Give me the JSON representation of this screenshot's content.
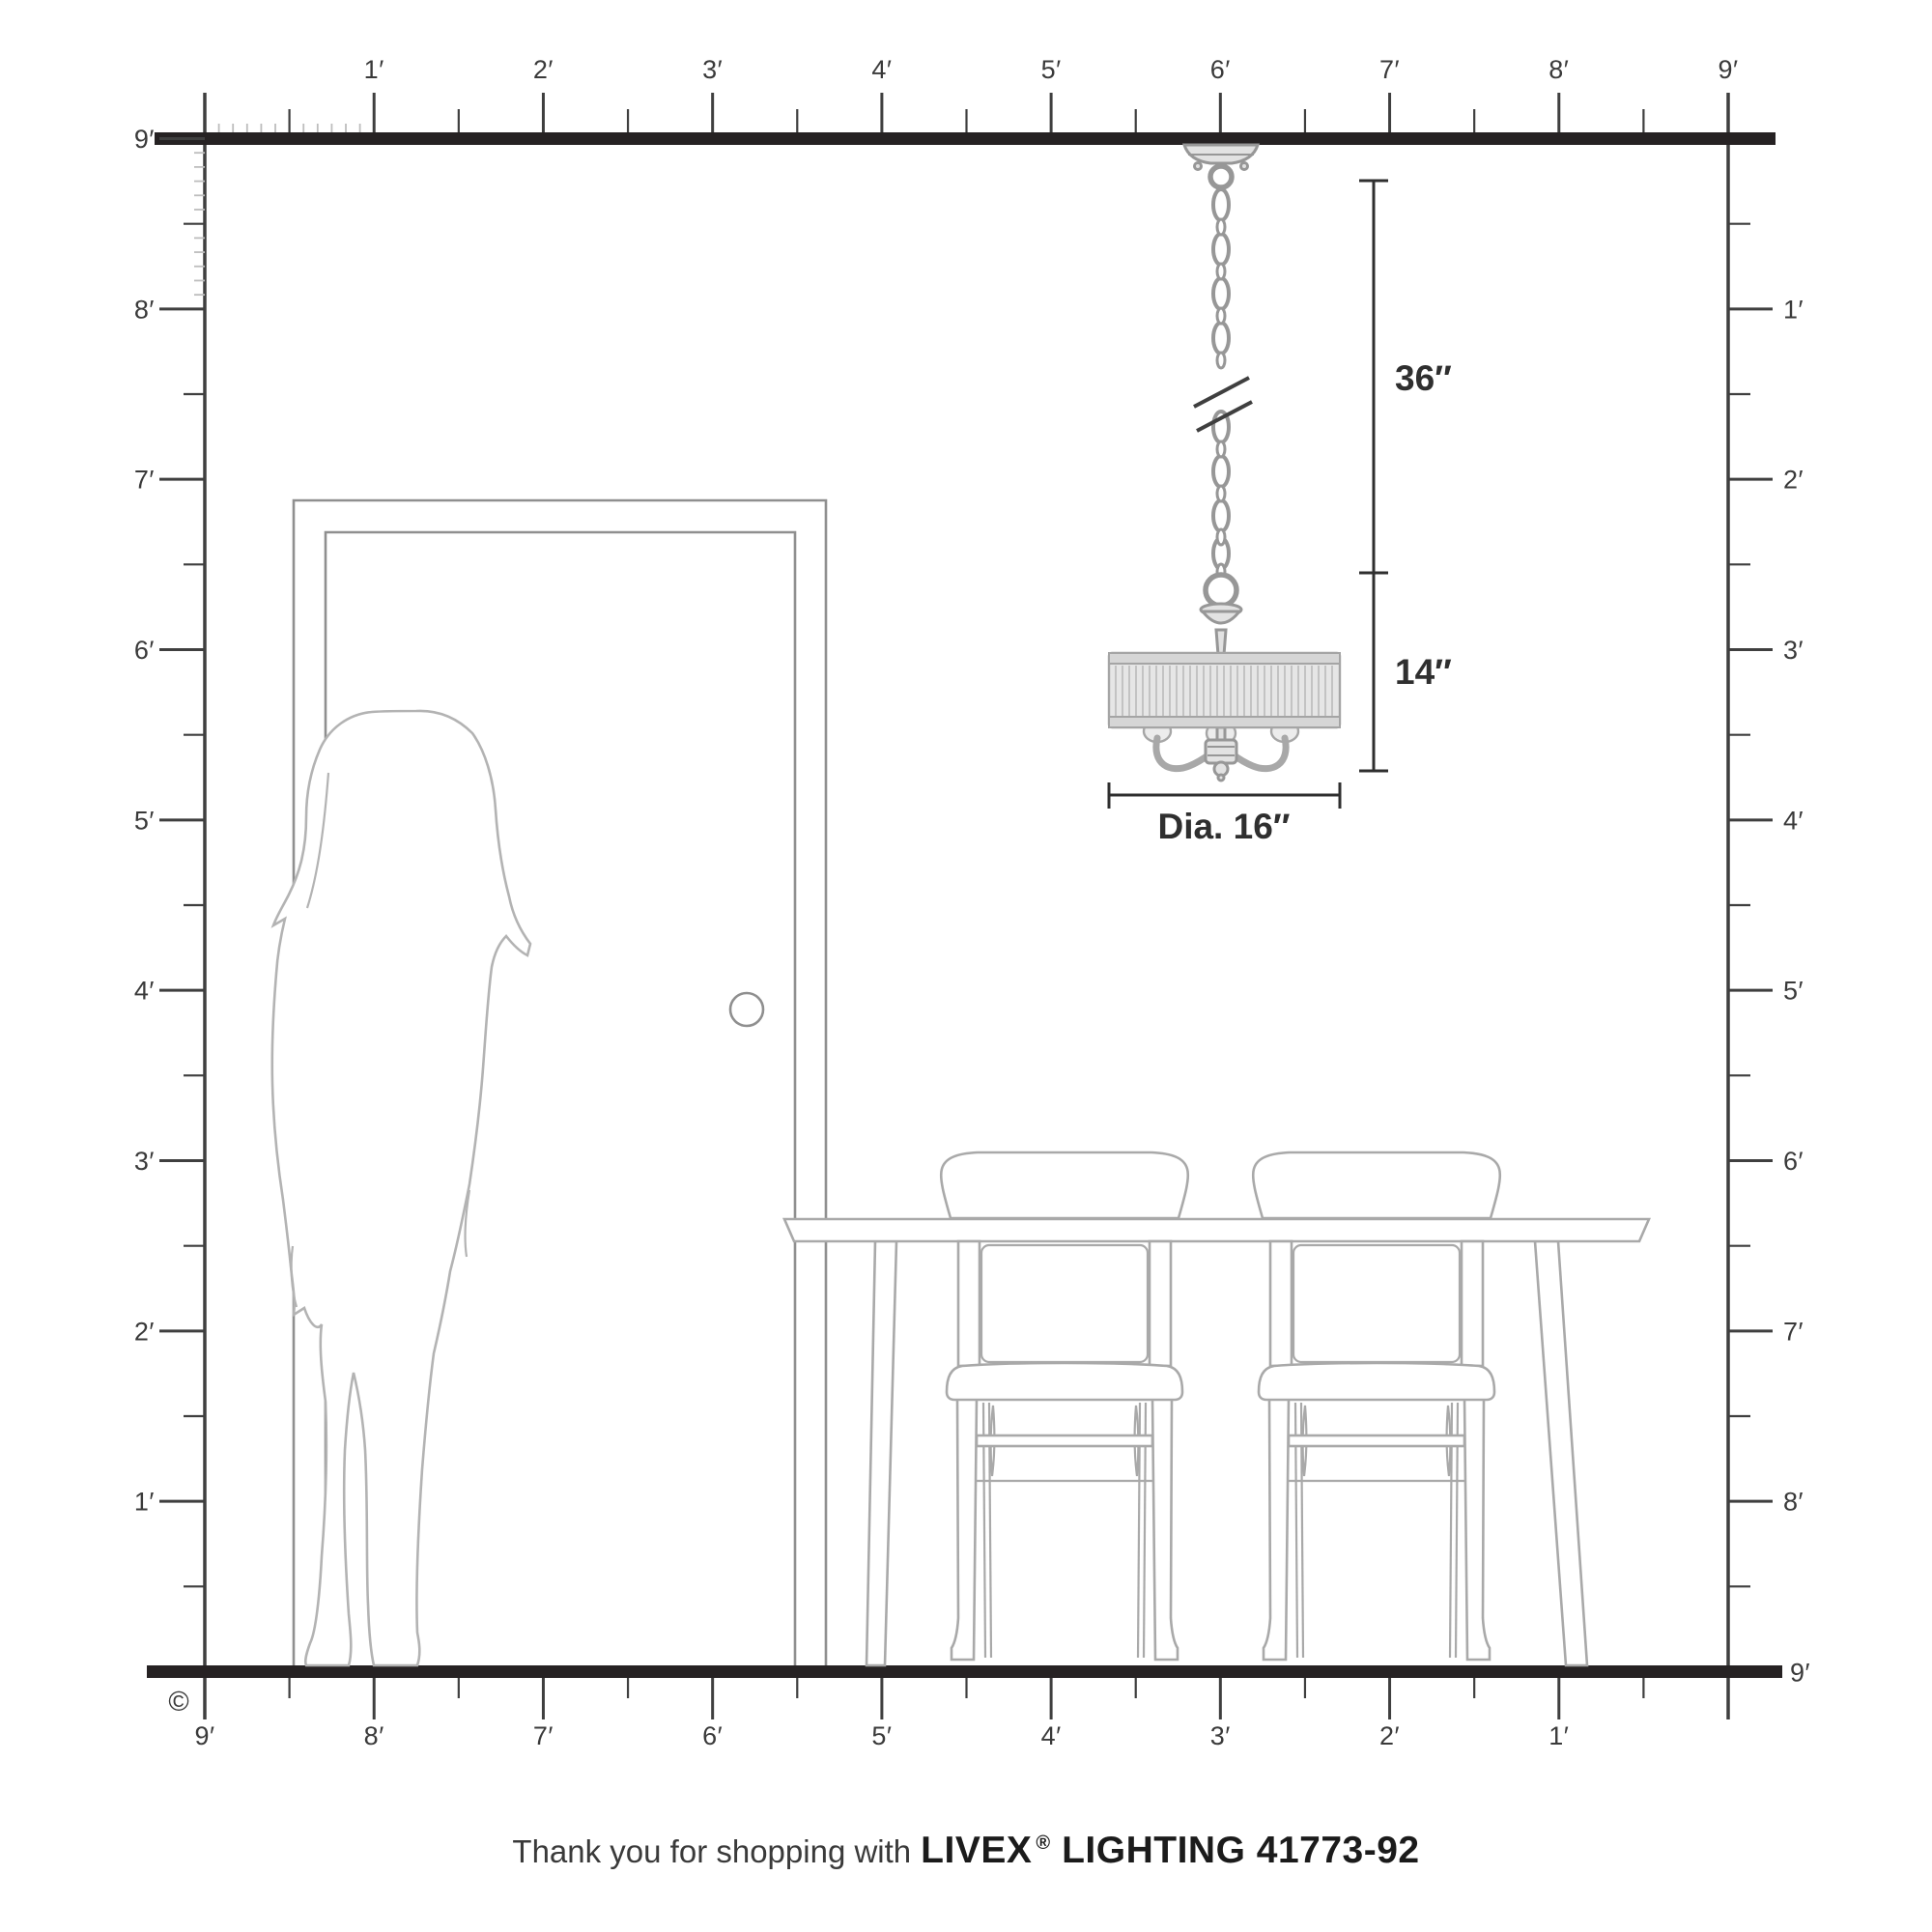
{
  "page": {
    "background": "#ffffff",
    "description_copyright": "©"
  },
  "rulers": {
    "top": [
      "1′",
      "2′",
      "3′",
      "4′",
      "5′",
      "6′",
      "7′",
      "8′",
      "9′"
    ],
    "left": [
      "9′",
      "8′",
      "7′",
      "6′",
      "5′",
      "4′",
      "3′",
      "2′",
      "1′"
    ],
    "right": [
      "1′",
      "2′",
      "3′",
      "4′",
      "5′",
      "6′",
      "7′",
      "8′",
      "9′"
    ],
    "bottom": [
      "9′",
      "8′",
      "7′",
      "6′",
      "5′",
      "4′",
      "3′",
      "2′",
      "1′"
    ]
  },
  "dimensions": {
    "chain_length": "36″",
    "fixture_height": "14″",
    "fixture_diameter": "Dia. 16″"
  },
  "footer": {
    "prefix": "Thank you for shopping with",
    "brand": "LIVEX",
    "registered": "®",
    "suffix": "LIGHTING 41773-92"
  },
  "colors": {
    "ink": "#262223",
    "ruler": "#3f3f3f",
    "tick_light": "#bdbdbd",
    "door": "#8f8f8f",
    "furniture": "#a9a9a9",
    "person": "#b3b3b3",
    "metal": "#979797",
    "metal_fill": "#e2e2e2",
    "shade_fill": "#e6e6e6",
    "shade_pleat": "#c3c3c3",
    "dimension": "#2f2f2f",
    "label": "#3a3a3a"
  }
}
